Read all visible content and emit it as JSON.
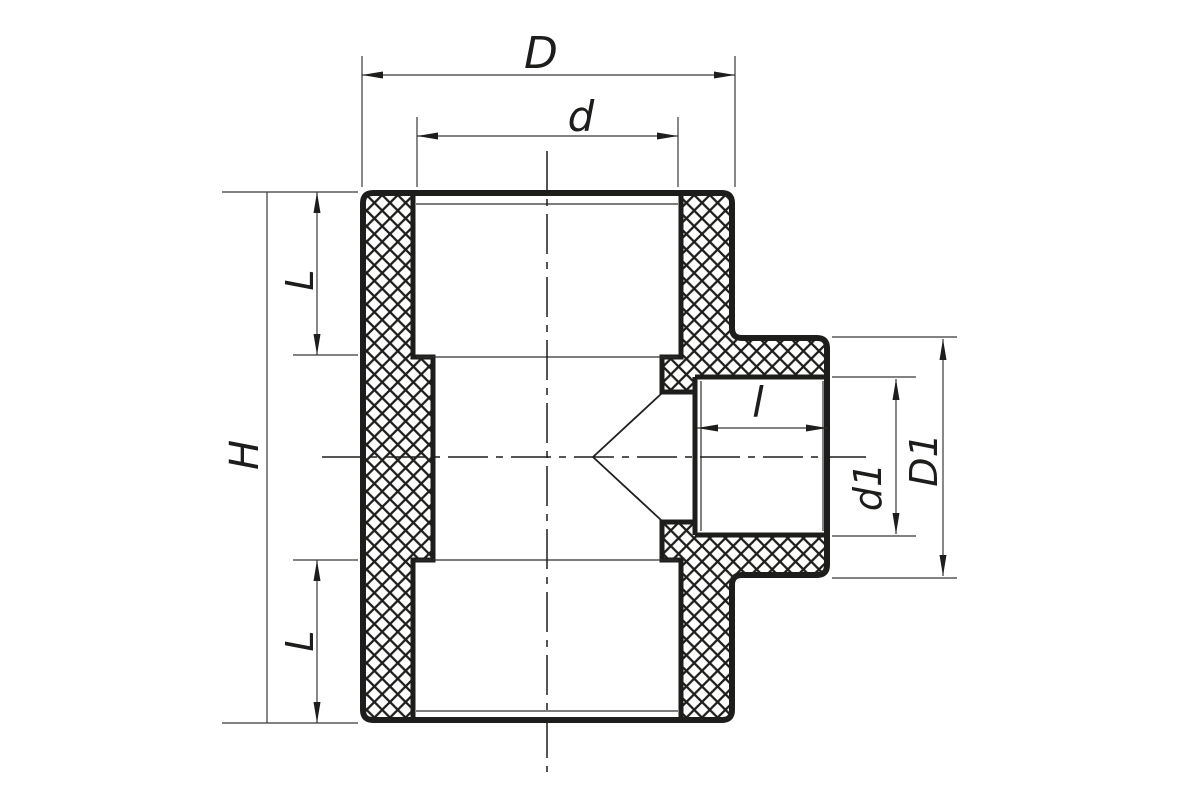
{
  "drawing": {
    "type": "technical-sectional-drawing",
    "subject": "reducing tee pipe fitting, cross-section with crosshatched cut walls",
    "colors": {
      "background": "#ffffff",
      "line": "#1d1d1b",
      "thin_line": "#2e2e2e",
      "dimension_line": "#383838"
    },
    "labels": {
      "overall_width": "D",
      "socket_bore": "d",
      "overall_height": "H",
      "socket_depth_top": "L",
      "socket_depth_bottom": "L",
      "branch_socket_depth": "l",
      "branch_bore": "d1",
      "branch_outer_diameter": "D1"
    }
  }
}
